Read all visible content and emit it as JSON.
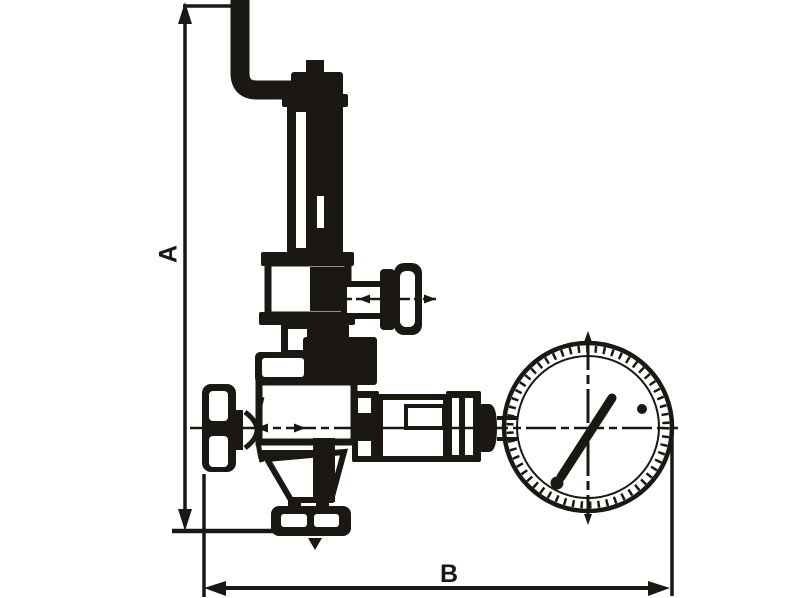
{
  "canvas": {
    "width": 800,
    "height": 598,
    "background_color": "#ffffff",
    "ink_color": "#1b1813"
  },
  "drawing": {
    "kind": "technical-dimensional-line-drawing",
    "subject": "Safety / pressure relief valve with side handwheels and pressure gauge",
    "dimension_labels": {
      "height": "A",
      "width": "B"
    },
    "parts": [
      {
        "name": "impulse-pipe",
        "description": "bent pipe/lever entering top of spring housing"
      },
      {
        "name": "adjusting-cap",
        "description": "cap on top of spring housing"
      },
      {
        "name": "spring-housing",
        "description": "tall vertical spring bonnet column"
      },
      {
        "name": "bonnet",
        "description": "rectangular bonnet block with flanges below housing"
      },
      {
        "name": "side-handwheel",
        "description": "small handwheel on right side stem"
      },
      {
        "name": "inlet-handwheel",
        "description": "handwheel on left inlet connection"
      },
      {
        "name": "valve-body",
        "description": "main valve body on horizontal centerline"
      },
      {
        "name": "outlet-flange",
        "description": "bottom outlet connection flange"
      },
      {
        "name": "gauge-connector",
        "description": "stepped union and hex nut joining body to gauge"
      },
      {
        "name": "pressure-gauge",
        "description": "round manometer dial with needle"
      }
    ]
  }
}
